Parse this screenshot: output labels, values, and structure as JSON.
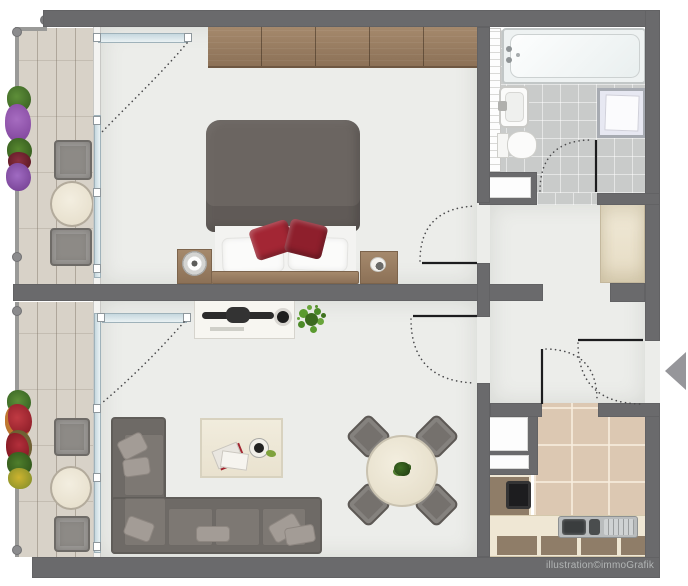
{
  "watermark": "illustration©immoGrafik",
  "plan": {
    "type": "apartment-floor-plan",
    "entrance_arrow_direction": "left",
    "rooms": [
      {
        "name": "bedroom",
        "furniture": [
          "wardrobe",
          "double-bed",
          "duvet",
          "white-pillows",
          "red-accent-pillows",
          "nightstand-left",
          "table-lamp",
          "nightstand-right",
          "balcony-window",
          "top-window"
        ]
      },
      {
        "name": "bathroom",
        "furniture": [
          "bathtub",
          "towel-radiator",
          "washbasin",
          "toilet",
          "shower",
          "wall-niche"
        ]
      },
      {
        "name": "hallway",
        "furniture": [
          "closet"
        ]
      },
      {
        "name": "living-room",
        "furniture": [
          "tv-sideboard",
          "tv",
          "speaker",
          "houseplant",
          "corner-sofa",
          "throw-pillows",
          "coffee-table",
          "magazines",
          "cup",
          "dining-table",
          "dining-chairs",
          "balcony-window"
        ]
      },
      {
        "name": "kitchen",
        "furniture": [
          "utility-column",
          "kitchen-counter",
          "cooktop",
          "kitchen-sink"
        ]
      },
      {
        "name": "balcony-top",
        "furniture": [
          "railing",
          "flower-boxes",
          "balcony-chair",
          "bistro-table",
          "balcony-chair"
        ]
      },
      {
        "name": "balcony-bottom",
        "furniture": [
          "railing",
          "flower-boxes",
          "balcony-chair",
          "bistro-table",
          "balcony-chair"
        ]
      }
    ],
    "doors": [
      "bedroom-door",
      "living-room-door",
      "bathroom-door",
      "kitchen-door",
      "entrance-door"
    ],
    "colors": {
      "wall": "#6a6a6c",
      "floor": "#ecedea",
      "balcony_plank": "#d8d2c8",
      "bath_tile": "#c9cbca",
      "kitchen_tile": "#dcc8b2",
      "wood": "#9b8168",
      "upholstery": "#6e6a66",
      "accent_red": "#a1242f",
      "plant_green": "#5a8f3c",
      "glazing": "#cfe0e8",
      "arrow": "#96969a",
      "watermark_text": "#b2b5b5"
    }
  }
}
